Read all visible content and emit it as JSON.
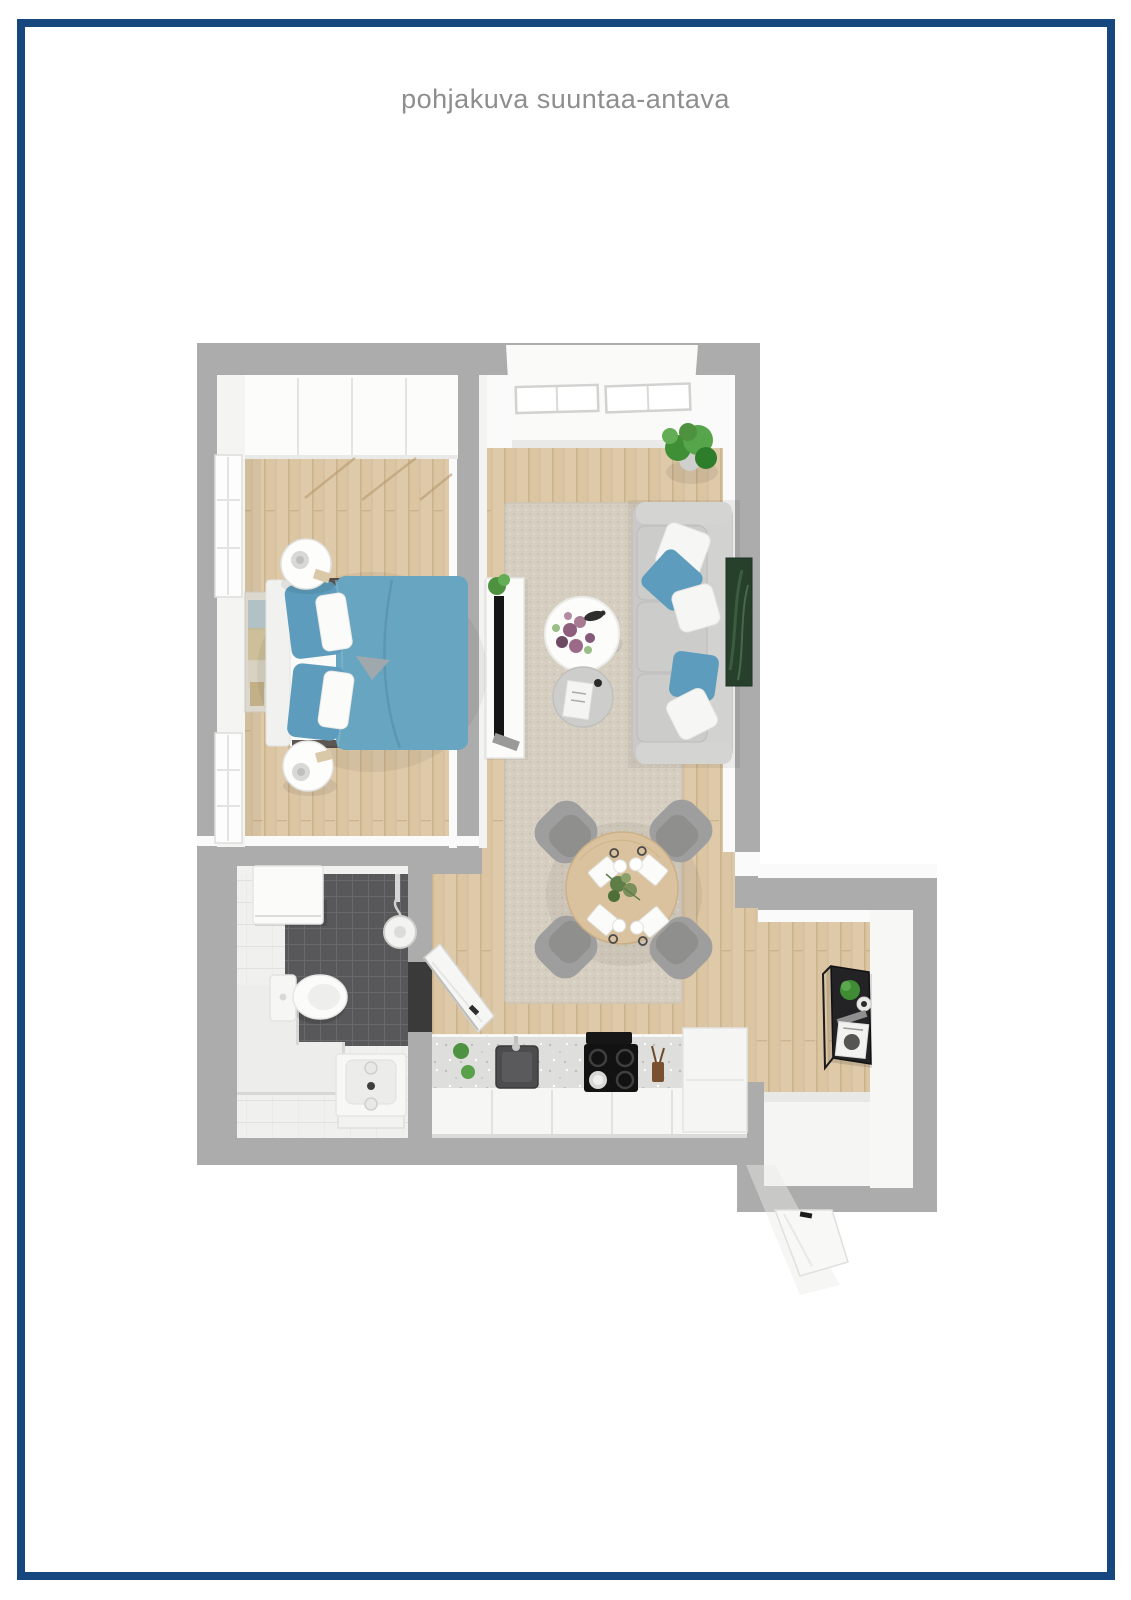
{
  "page": {
    "title": "pohjakuva suuntaa-antava"
  },
  "colors": {
    "frame_blue": "#17477F",
    "title_gray": "#8E8E8E",
    "wall_gray": "#ACACAC",
    "wall_face_white": "#FAFAFA",
    "floor_wood": "#DBC5A3",
    "wood_stripe": "#C8B089",
    "rug_beige": "#D6CFC1",
    "sofa_gray": "#C9C9C9",
    "accent_blue": "#68A5C1",
    "pillow_blue": "#5D9CBC",
    "dark_tile": "#58585A",
    "light_tile": "#F0F0EF",
    "counter_speckle": "#DEDEDC",
    "appliance_black": "#161616",
    "table_wood": "#D9C29D",
    "chair_gray": "#9E9E9E",
    "plant_green": "#4E9240",
    "desk_black": "#232325"
  }
}
